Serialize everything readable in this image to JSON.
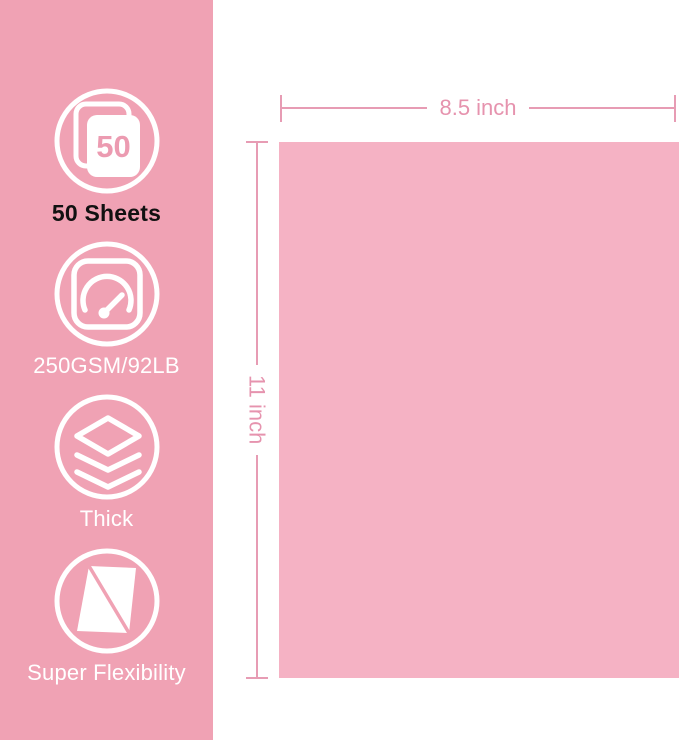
{
  "colors": {
    "sidebar_background": "#F0A2B4",
    "paper_fill": "#F5B2C4",
    "dimension_accent": "#E79CB4",
    "dimension_text": "#E693AE",
    "icon_stroke": "#FFFFFF",
    "badge_text_pink": "#EC9BB1",
    "feature_label_light": "#FFFFFF",
    "feature_label_dark": "#111111"
  },
  "sidebar": {
    "features": [
      {
        "icon": "sheet-count-icon",
        "badge": "50",
        "label": "50 Sheets"
      },
      {
        "icon": "gauge-icon",
        "label": "250GSM/92LB"
      },
      {
        "icon": "layers-thickness-icon",
        "label": "Thick"
      },
      {
        "icon": "flexible-sheet-icon",
        "label": "Super Flexibility"
      }
    ]
  },
  "diagram": {
    "paper": {
      "width_label": "8.5 inch",
      "height_label": "11 inch"
    }
  }
}
